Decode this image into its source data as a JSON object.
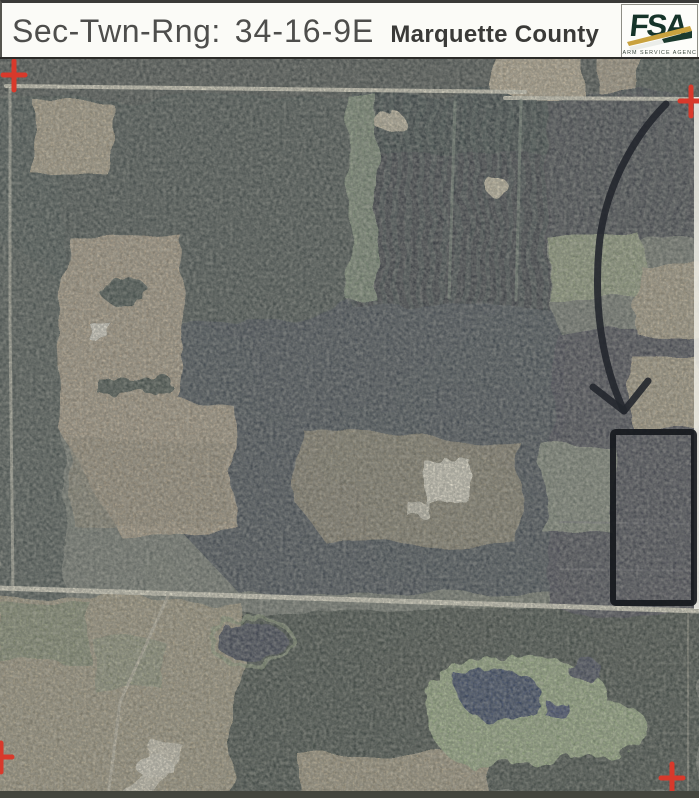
{
  "header": {
    "label": "Sec-Twn-Rng:",
    "value": "34-16-9E",
    "county": "Marquette County"
  },
  "logo": {
    "acronym": "FSA",
    "caption": "FARM SERVICE AGENCY",
    "brand_green": "#1e3a2f",
    "brand_gold": "#c9a23f"
  },
  "map": {
    "kind": "aerial photograph with FSA annotations",
    "cross_color": "#d8392b",
    "annotation_color": "#1a1d22",
    "registration_cross_count": 4,
    "features": {
      "parcel_outline": "black rectangle outlining target parcel, east side",
      "arrow": "black curved arrow pointing down to parcel",
      "crosses": "red registration crosses near the four corners"
    }
  }
}
